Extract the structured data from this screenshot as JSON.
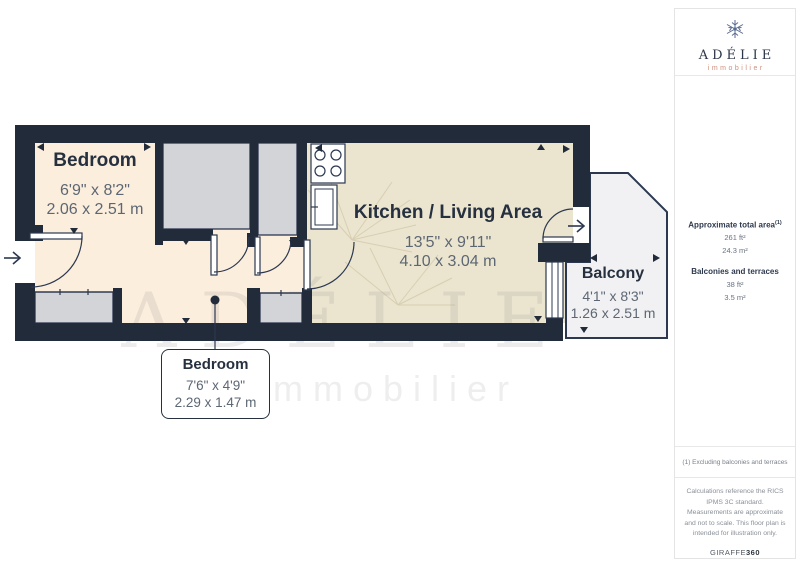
{
  "logo": {
    "name": "ADÉLIE",
    "sub": "immobilier"
  },
  "watermark": {
    "line1": "ADÉLIE",
    "line2": "immobilier"
  },
  "rooms": {
    "bedroom1": {
      "name": "Bedroom",
      "imperial": "6'9\" x 8'2\"",
      "metric": "2.06 x 2.51 m"
    },
    "kitchen": {
      "name": "Kitchen / Living Area",
      "imperial": "13'5\" x 9'11\"",
      "metric": "4.10 x 3.04 m"
    },
    "balcony": {
      "name": "Balcony",
      "imperial": "4'1\" x 8'3\"",
      "metric": "1.26 x 2.51 m"
    },
    "bedroom2": {
      "name": "Bedroom",
      "imperial": "7'6\" x 4'9\"",
      "metric": "2.29 x 1.47 m"
    }
  },
  "sidebar": {
    "total_area_label": "Approximate total area",
    "total_area_ref": "(1)",
    "total_area_ft": "261 ft²",
    "total_area_m": "24.3 m²",
    "balcony_label": "Balconies and terraces",
    "balcony_ft": "38 ft²",
    "balcony_m": "3.5 m²",
    "footnote": "(1) Excluding balconies and terraces",
    "disclaimer": "Calculations reference the RICS IPMS 3C standard. Measurements are approximate and not to scale. This floor plan is intended for illustration only.",
    "brand": "GIRAFFE",
    "brand_suffix": "360"
  },
  "colors": {
    "wall": "#212b3a",
    "floor_warm": "#fceedd",
    "floor_kitchen": "#ebe5cf",
    "room_gray": "#d2d4d7",
    "balcony_fill": "#f1f1f3",
    "logo_navy": "#2c3547",
    "accent_salmon": "#cf8f7d",
    "dim_text": "#5d6773"
  }
}
